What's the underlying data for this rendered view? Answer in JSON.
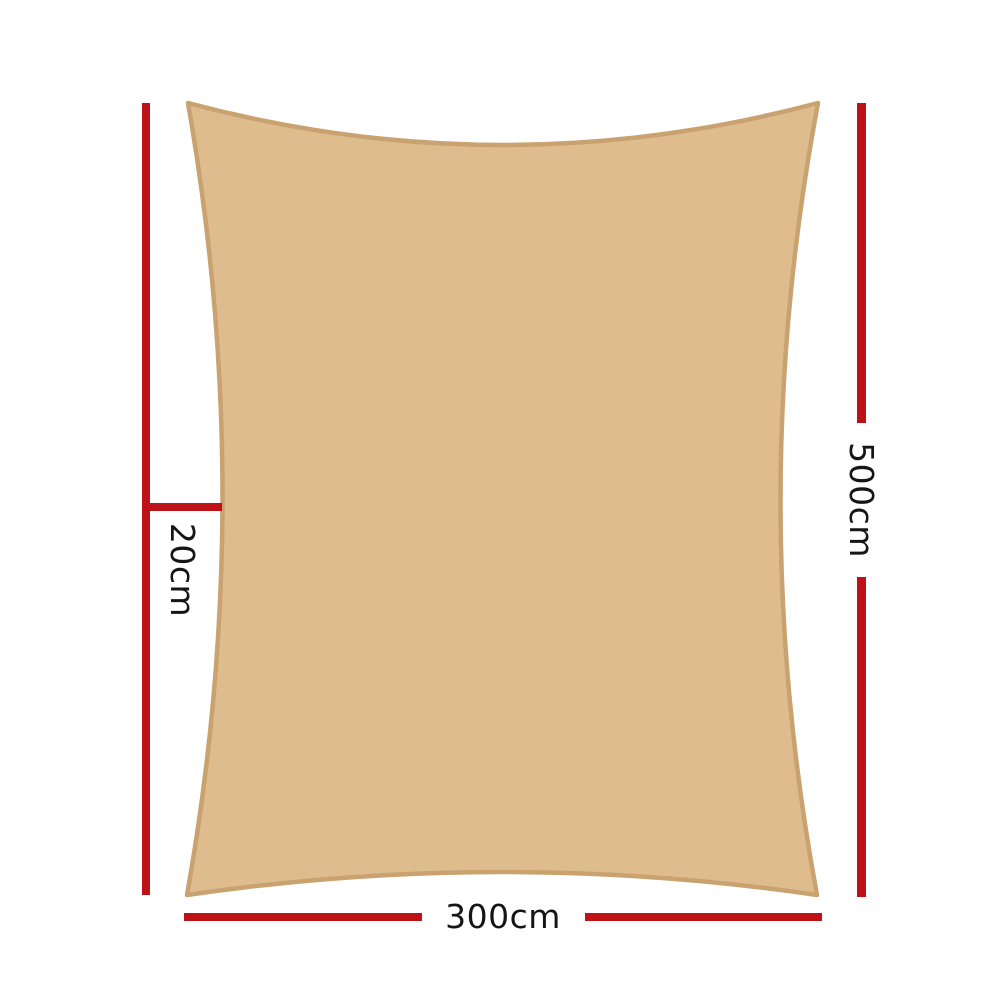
{
  "diagram": {
    "title": "Shade sail dimension diagram",
    "sail": {
      "fill_color": "#DEBC8D",
      "border_color": "#C9A26F"
    },
    "dimension_lines": {
      "color": "#BC1218",
      "height_label": "500cm",
      "width_label": "300cm",
      "edge_curve_label": "20cm"
    }
  }
}
